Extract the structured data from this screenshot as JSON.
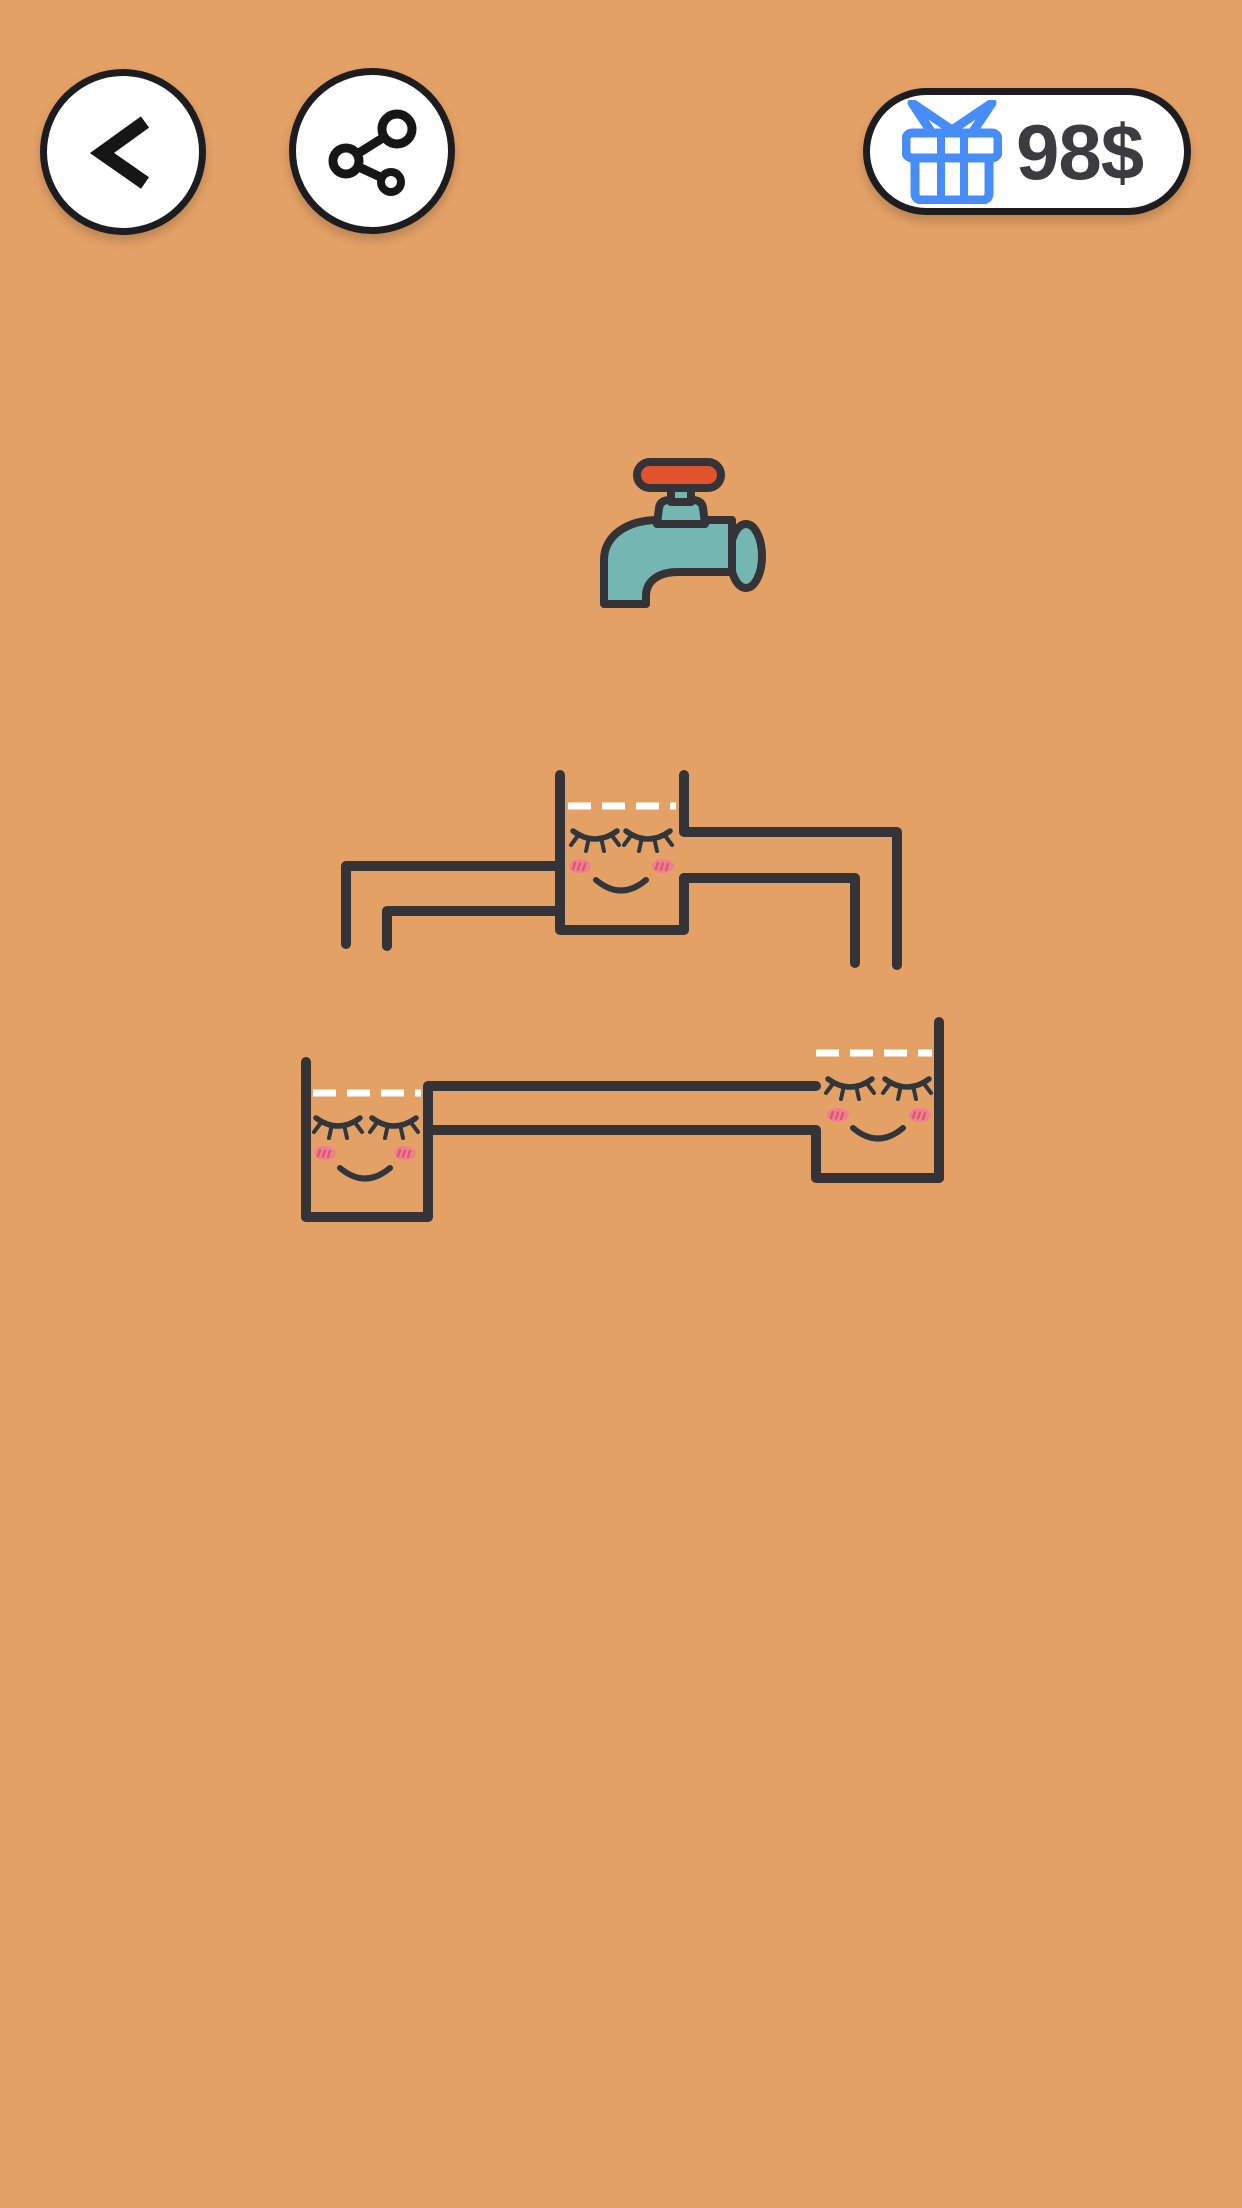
{
  "app": {
    "type": "water-pipes-puzzle-game"
  },
  "header": {
    "back_button": {
      "icon": "chevron-left-icon"
    },
    "share_button": {
      "icon": "share-icon"
    },
    "reward_button": {
      "icon": "gift-icon",
      "label": "98$"
    }
  },
  "scene": {
    "faucet": {
      "icon": "faucet-icon",
      "state": "closed"
    },
    "puzzles": [
      {
        "name": "puzzle-1",
        "cups": [
          {
            "face": "sleeping-smile",
            "fill_target": "dashed-white-line"
          }
        ],
        "pipes": [
          "left-elbow-down-pipe",
          "right-elbow-down-pipe"
        ]
      },
      {
        "name": "puzzle-2",
        "cups": [
          {
            "face": "sleeping-smile",
            "fill_target": "dashed-white-line"
          },
          {
            "face": "sleeping-smile",
            "fill_target": "dashed-white-line"
          }
        ],
        "pipes": [
          "long-horizontal-connector-pipe"
        ]
      }
    ]
  },
  "colors": {
    "background": "#e4a166",
    "line": "#333338",
    "white": "#ffffff",
    "button_bg": "#ffffff",
    "button_border": "#1d1d1f",
    "gift_blue": "#478cf7",
    "money_text": "#3c3c3e",
    "faucet_teal": "#74b7b2",
    "faucet_red": "#e0532d",
    "blush": "#f0808f",
    "blush_mark": "#d85a70",
    "eye": "#32353a"
  }
}
